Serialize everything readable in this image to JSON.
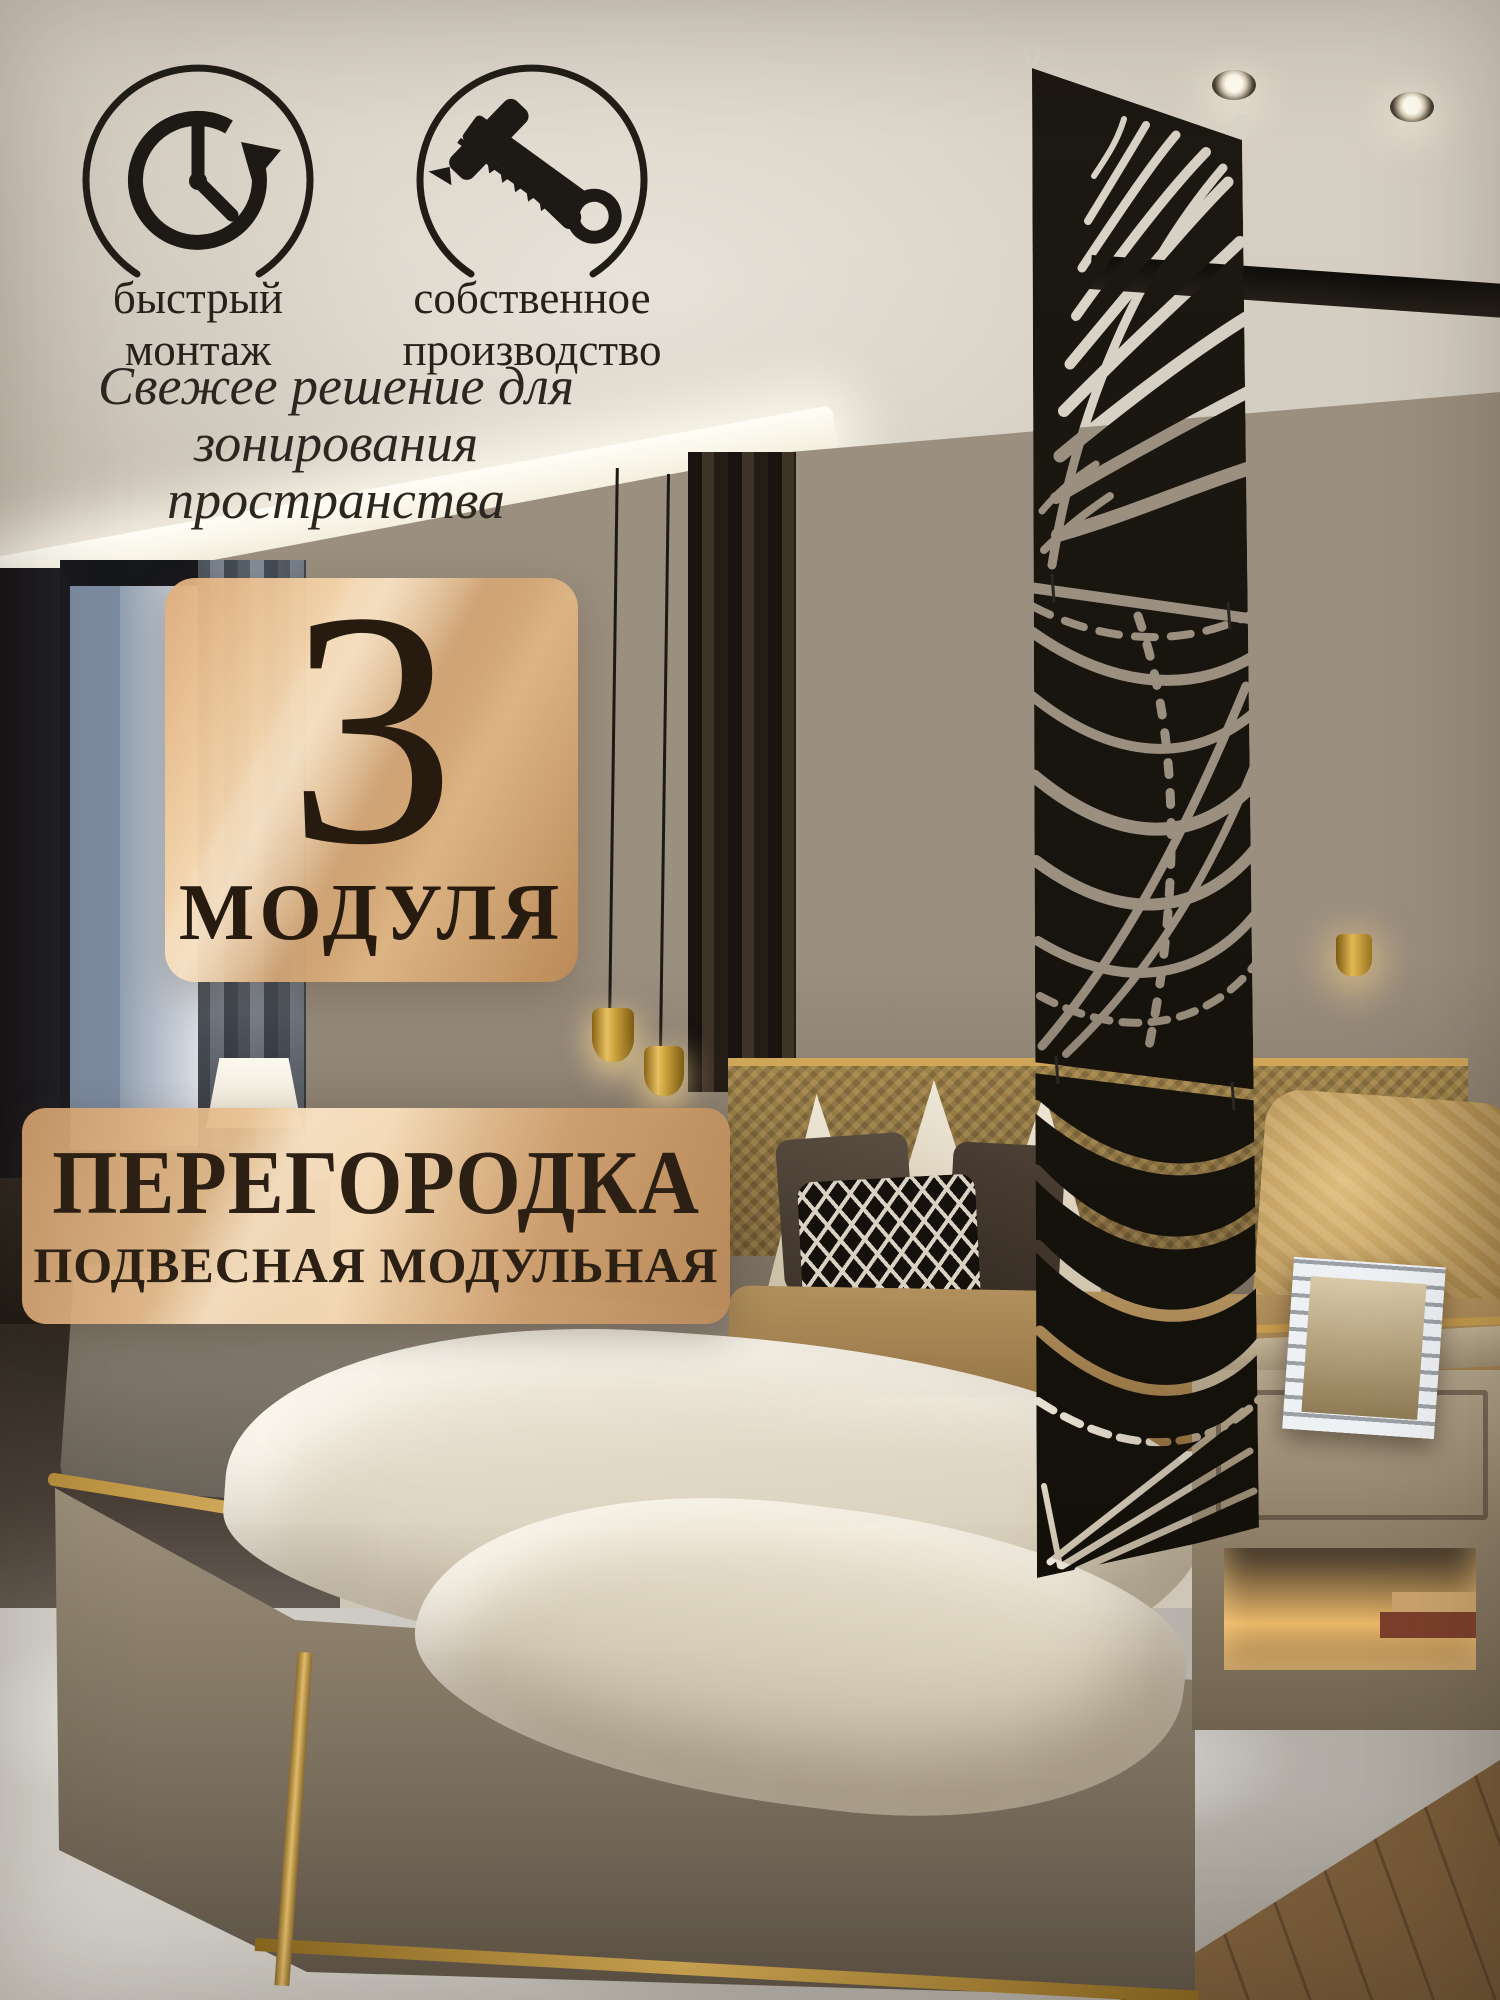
{
  "features": [
    {
      "icon": "clock-fast-installation-icon",
      "line1": "быстрый",
      "line2": "монтаж"
    },
    {
      "icon": "hammer-saw-tools-icon",
      "line1": "собственное",
      "line2": "производство"
    }
  ],
  "tagline": {
    "line1": "Свежее решение для",
    "line2": "зонирования пространства"
  },
  "badge": {
    "number": "3",
    "label": "МОДУЛЯ"
  },
  "banner": {
    "title": "ПЕРЕГОРОДКА",
    "subtitle": "ПОДВЕСНАЯ МОДУЛЬНАЯ"
  },
  "colors": {
    "backdrop_beige": "#d2cbbf",
    "copper_light": "#f6d8b0",
    "copper": "#cf9e6e",
    "copper_dark": "#bc8955",
    "text_dark": "#261b0e",
    "panel_black": "#17130e",
    "gold_accent": "#caa04e"
  }
}
